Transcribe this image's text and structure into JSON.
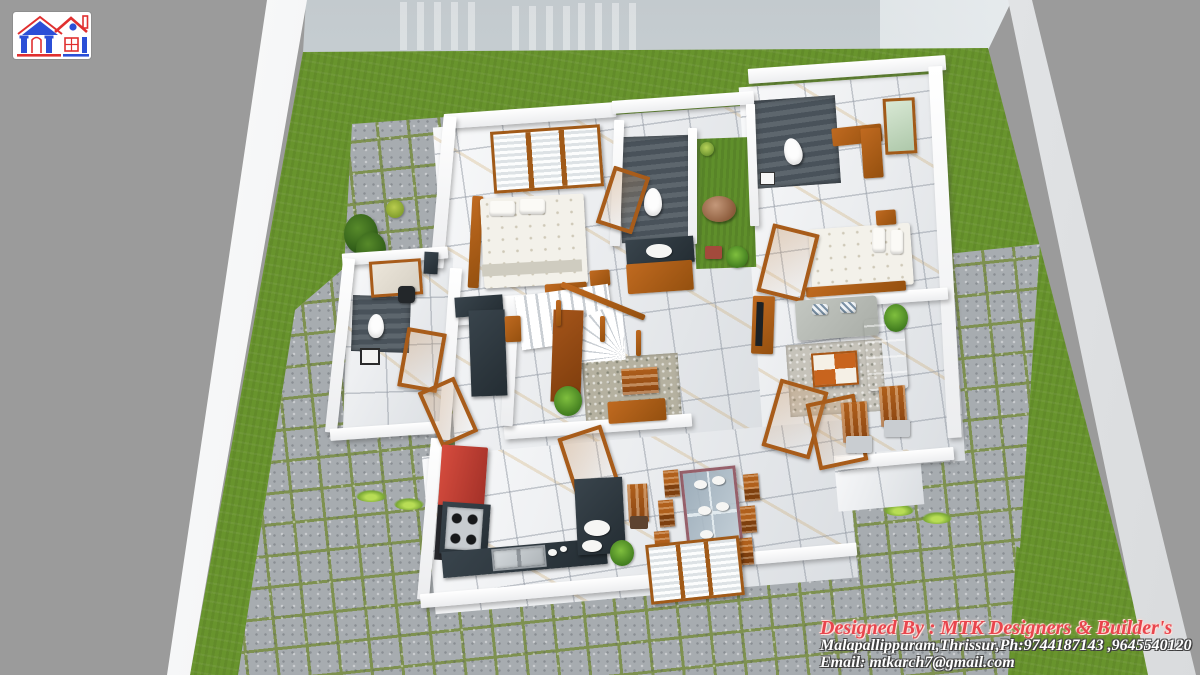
{
  "title": "3D floor plan visualization",
  "logo": {
    "icon": "house-logo-icon"
  },
  "credits": {
    "designed_by": "Designed By : MTK Designers & Builder's",
    "address_phone": "Malapallippuram,Thrissur,Ph:9744187143 ,9645540120",
    "email": "Email: mtkarch7@gmail.com"
  },
  "colors": {
    "background": "#9b9b9b",
    "compound_wall": "#f5f6f8",
    "boundary_wall_face": "#ccd3d7",
    "grass": "#68942d",
    "pavement": "#a7acb0",
    "pavement_grout": "#7e9150",
    "house_wall": "#f6f7f9",
    "marble_floor": "#eef0f3",
    "bathroom_slate": "#525b62",
    "wood": "#a85c1a",
    "kitchen_red": "#c7413a",
    "counter_dark": "#2b3339",
    "sofa_gray": "#b6bab4",
    "credit_red": "#e8454d",
    "credit_white": "#ffffff"
  },
  "scene": {
    "type": "3d-isometric-floor-plan-render",
    "rooms": [
      "bedroom-1",
      "bathroom-1",
      "courtyard",
      "bathroom-2",
      "bedroom-2",
      "living-room",
      "stair-hall",
      "foyer",
      "work-area",
      "bathroom-3",
      "kitchen",
      "dining-area",
      "sit-out-terrace"
    ],
    "landscape": [
      "lawn",
      "paved-tile-yard",
      "compound-wall",
      "grass-tufts",
      "tree",
      "shrubs"
    ],
    "furniture": [
      "double-bed",
      "double-bed",
      "toilet",
      "toilet",
      "toilet",
      "wash-vanity",
      "round-table",
      "stool",
      "sofa-set",
      "coffee-table",
      "tv-unit",
      "staircase",
      "wooden-railing",
      "bench",
      "teapoy",
      "study-desk",
      "office-chair",
      "kitchen-tall-unit",
      "hob-counter",
      "sink-counter",
      "breakfast-counter",
      "dining-table",
      "dining-chairs",
      "windows",
      "open-doors",
      "planters"
    ]
  }
}
